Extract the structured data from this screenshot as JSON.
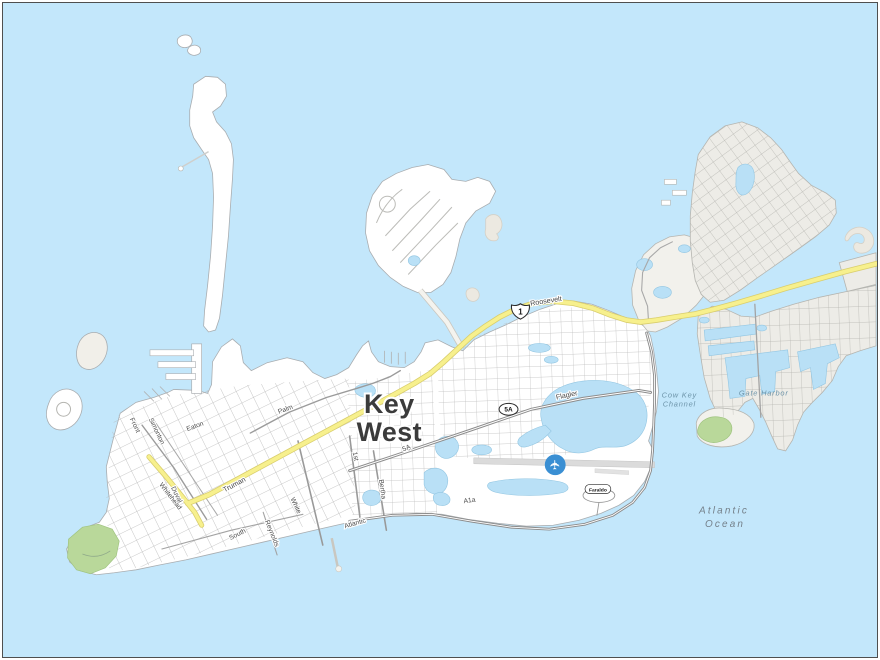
{
  "map": {
    "city": {
      "line1": "Key",
      "line2": "West"
    },
    "streets": {
      "front": "Front",
      "simonton": "Simonton",
      "eaton": "Eaton",
      "palm": "Palm",
      "duval": "Duval",
      "whitehead": "Whitehead",
      "truman": "Truman",
      "white": "White",
      "south": "South",
      "reynolds": "Reynolds",
      "atlantic": "Atlantic",
      "first": "1st",
      "bertha": "Bertha",
      "route5a": "5A",
      "flagler": "Flagler",
      "roosevelt": "Roosevelt",
      "a1a": "A1a"
    },
    "water": {
      "cow_key_1": "Cow Key",
      "cow_key_2": "Channel",
      "gate_harbor": "Gate Harbor",
      "ocean_1": "Atlantic",
      "ocean_2": "Ocean"
    },
    "shields": {
      "us1": "1",
      "sr5a": "5A",
      "faraldo": "Faraldo"
    },
    "airport_icon": "✈",
    "colors": {
      "water": "#c3e7fb",
      "land": "#ffffff",
      "land_secondary": "#edece7",
      "highway": "#f7f08d",
      "park": "#b9d89a",
      "airport": "#3a8fd3"
    }
  }
}
